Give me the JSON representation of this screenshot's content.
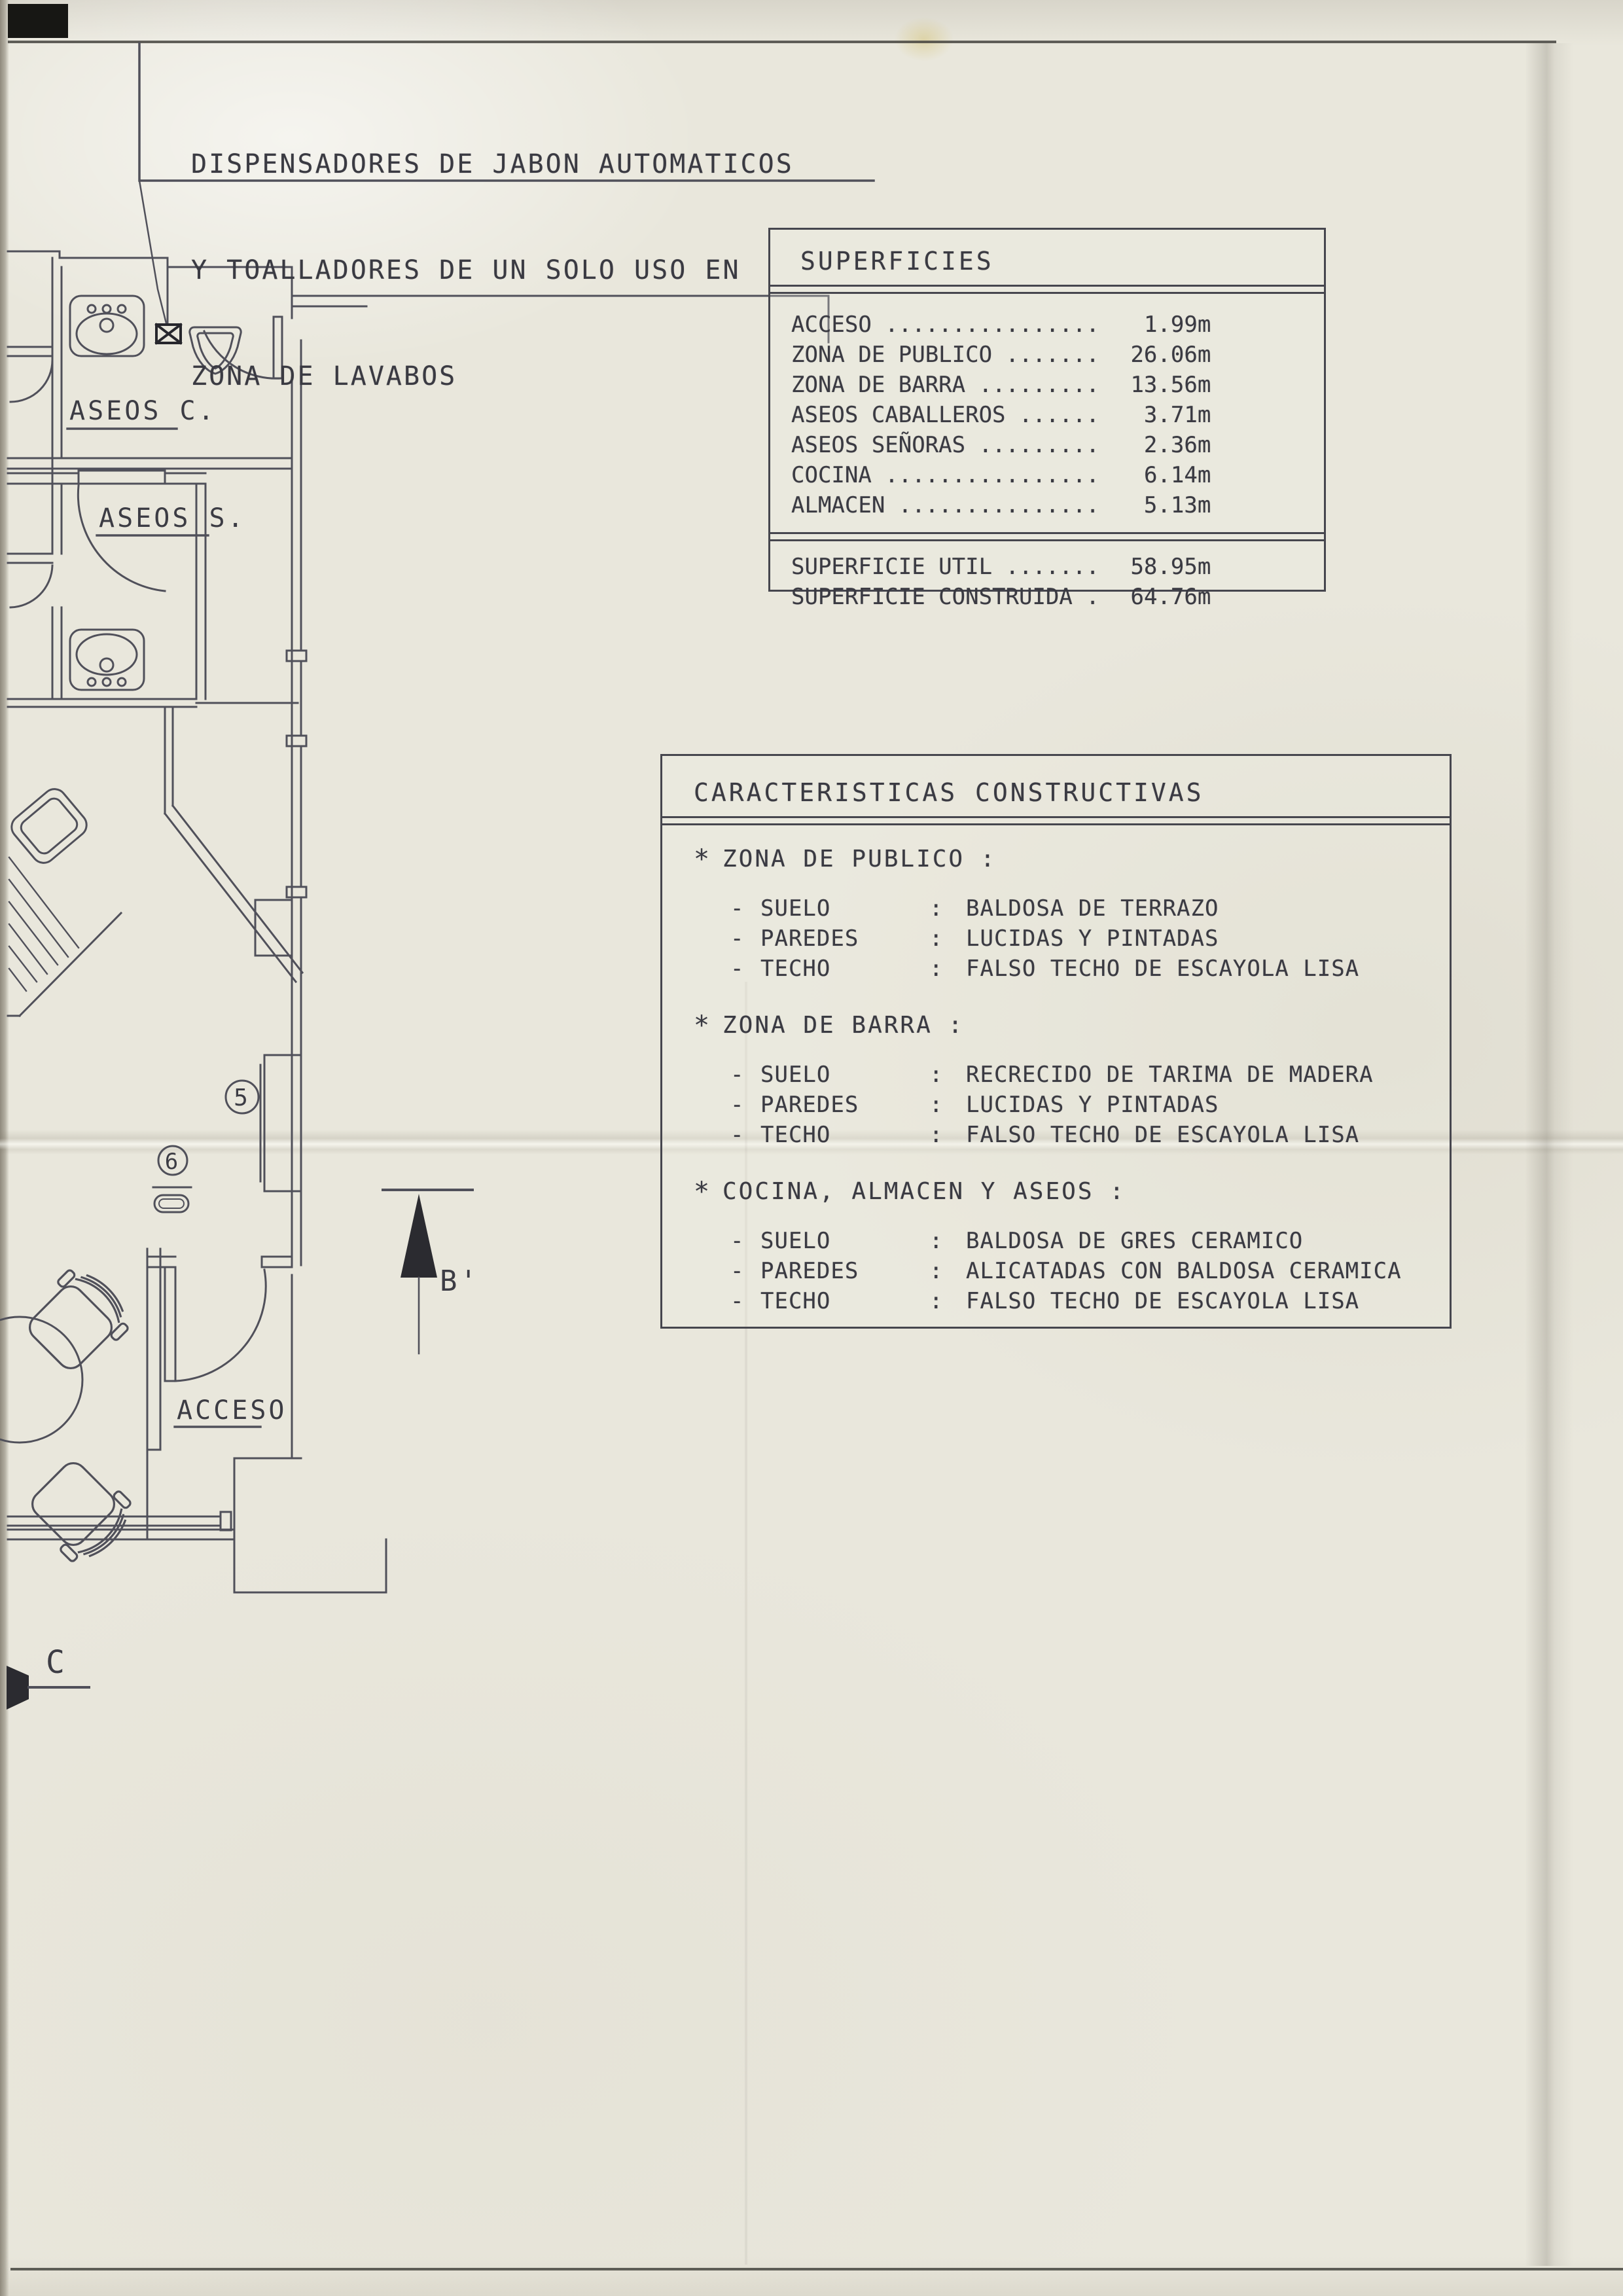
{
  "annotation": {
    "line1": "DISPENSADORES DE JABON AUTOMATICOS",
    "line2": "Y TOALLADORES DE UN SOLO USO EN",
    "line3": "ZONA DE LAVABOS"
  },
  "plan": {
    "room_labels": {
      "aseos_c": "ASEOS C.",
      "aseos_s": "ASEOS S.",
      "acceso": "ACCESO"
    },
    "markers": {
      "num5": "5",
      "num6": "6",
      "section_b": "B'",
      "section_c": "C"
    }
  },
  "superficies": {
    "title": "SUPERFICIES",
    "items": [
      {
        "label": "ACCESO",
        "dots": " ................",
        "value": "1.99",
        "unit": "m"
      },
      {
        "label": "ZONA DE PUBLICO",
        "dots": " .......",
        "value": "26.06",
        "unit": "m"
      },
      {
        "label": "ZONA DE BARRA",
        "dots": " .........",
        "value": "13.56",
        "unit": "m"
      },
      {
        "label": "ASEOS CABALLEROS",
        "dots": " ......",
        "value": "3.71",
        "unit": "m"
      },
      {
        "label": "ASEOS SEÑORAS",
        "dots": " .........",
        "value": "2.36",
        "unit": "m"
      },
      {
        "label": "COCINA",
        "dots": " ................",
        "value": "6.14",
        "unit": "m"
      },
      {
        "label": "ALMACEN",
        "dots": " ...............",
        "value": "5.13",
        "unit": "m"
      }
    ],
    "totals": [
      {
        "label": "SUPERFICIE UTIL",
        "dots": " .......",
        "value": "58.95",
        "unit": "m"
      },
      {
        "label": "SUPERFICIE CONSTRUIDA",
        "dots": " .",
        "value": "64.76",
        "unit": "m"
      }
    ]
  },
  "caracteristicas": {
    "title": "CARACTERISTICAS CONSTRUCTIVAS",
    "sections": [
      {
        "marker": "*",
        "heading": "ZONA DE PUBLICO",
        "colon": ":",
        "rows": [
          {
            "dash": "-",
            "label": "SUELO",
            "colon": ":",
            "value": "BALDOSA DE TERRAZO"
          },
          {
            "dash": "-",
            "label": "PAREDES",
            "colon": ":",
            "value": "LUCIDAS Y PINTADAS"
          },
          {
            "dash": "-",
            "label": "TECHO",
            "colon": ":",
            "value": "FALSO TECHO DE ESCAYOLA LISA"
          }
        ]
      },
      {
        "marker": "*",
        "heading": "ZONA DE BARRA",
        "colon": ":",
        "rows": [
          {
            "dash": "-",
            "label": "SUELO",
            "colon": ":",
            "value": "RECRECIDO DE TARIMA DE MADERA"
          },
          {
            "dash": "-",
            "label": "PAREDES",
            "colon": ":",
            "value": "LUCIDAS Y PINTADAS"
          },
          {
            "dash": "-",
            "label": "TECHO",
            "colon": ":",
            "value": "FALSO TECHO DE ESCAYOLA LISA"
          }
        ]
      },
      {
        "marker": "*",
        "heading": "COCINA, ALMACEN Y ASEOS",
        "colon": ":",
        "rows": [
          {
            "dash": "-",
            "label": "SUELO",
            "colon": ":",
            "value": "BALDOSA DE GRES CERAMICO"
          },
          {
            "dash": "-",
            "label": "PAREDES",
            "colon": ":",
            "value": "ALICATADAS CON BALDOSA CERAMICA"
          },
          {
            "dash": "-",
            "label": "TECHO",
            "colon": ":",
            "value": "FALSO TECHO DE ESCAYOLA LISA"
          }
        ]
      }
    ]
  },
  "colors": {
    "ink": "#3a3a42",
    "plan_line": "#50505a",
    "paper": "#e9e7dc",
    "corner_mark": "#171714"
  }
}
